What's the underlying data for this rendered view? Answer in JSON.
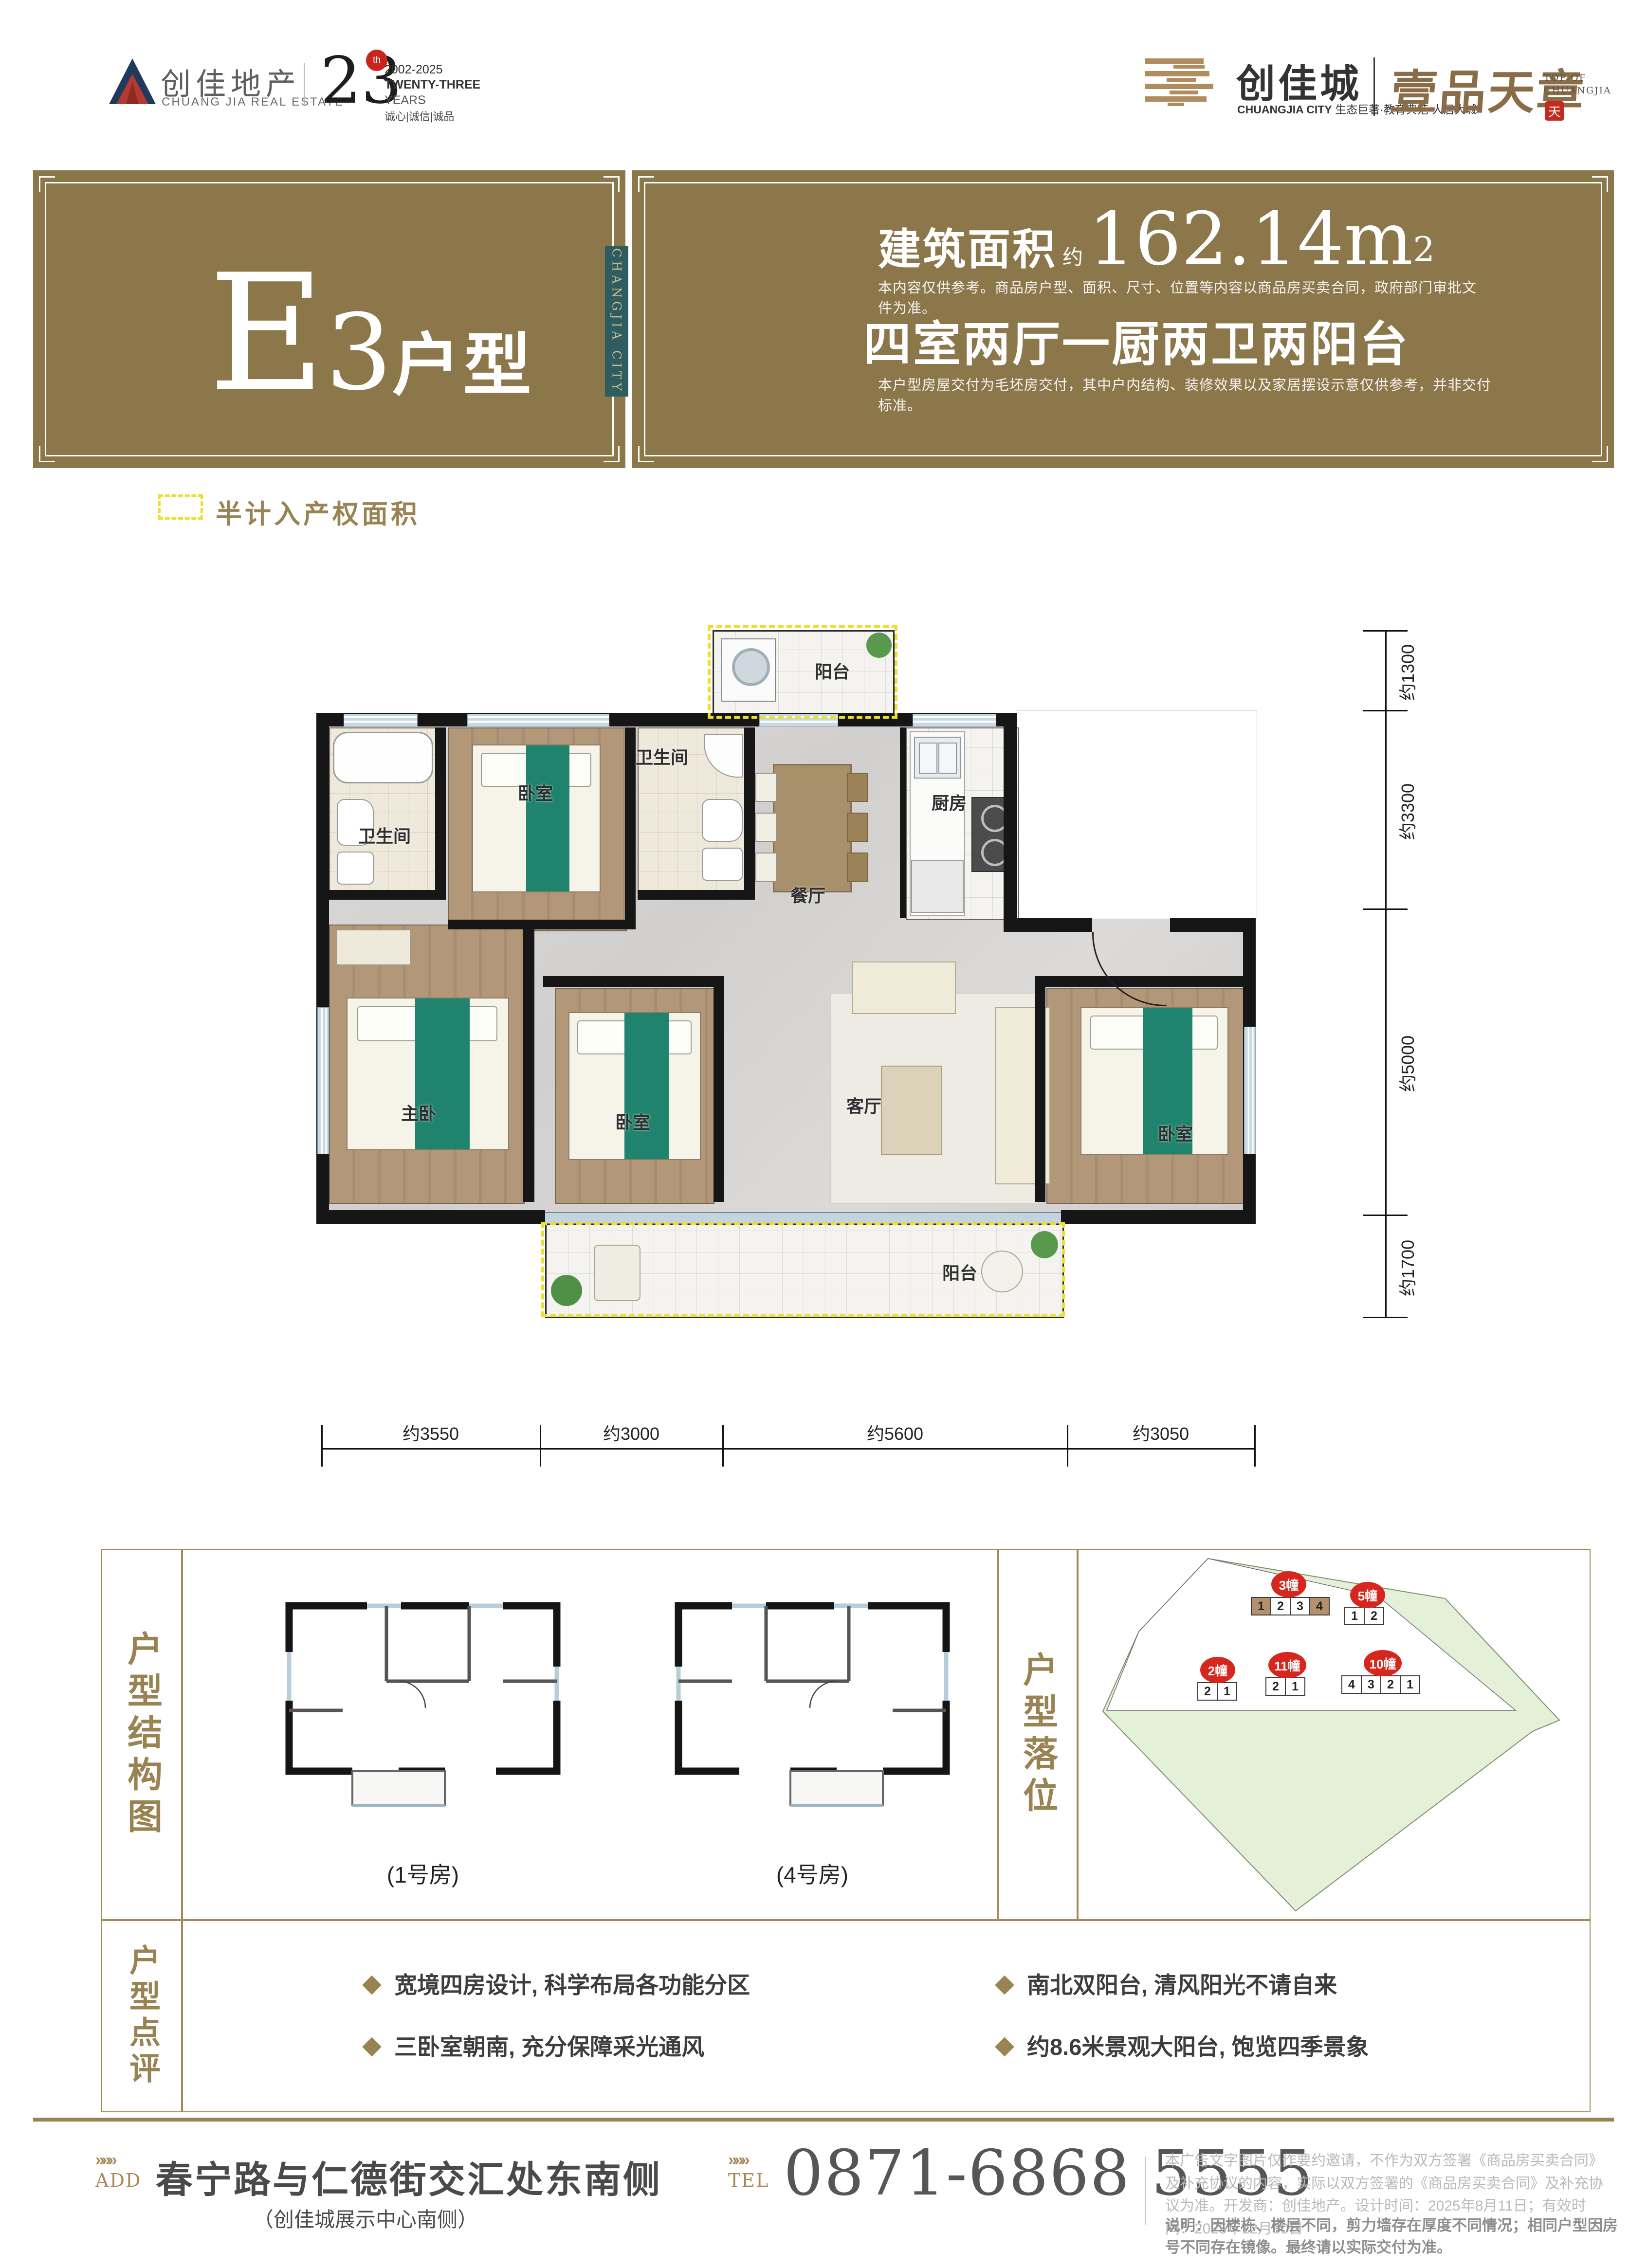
{
  "brand_left": {
    "cn": "创佳地产",
    "en": "CHUANG JIA REAL ESTATE",
    "years_num": "23",
    "years_sup": "th",
    "years_range": "2002-2025",
    "years_en": "TWENTY-THREE",
    "years_label": "YEARS",
    "slogan": "诚心|诚信|诚品"
  },
  "brand_right": {
    "cn": "创佳城",
    "en_bold": "CHUANGJIA CITY",
    "tagline": "生态巨著·教育典范·人居大城",
    "calligraphy": "壹品天章",
    "top_en_1": "TOP OF",
    "top_en_2": "CHUANGJIA",
    "seal": "天"
  },
  "header": {
    "unit_main": "E",
    "unit_num": "3",
    "unit_suffix": "户型",
    "side_tab": "CHANGJIA CITY",
    "area_label": "建筑面积",
    "area_approx": "约",
    "area_value": "162.14m",
    "area_sup": "2",
    "disclaimer1": "本内容仅供参考。商品房户型、面积、尺寸、位置等内容以商品房买卖合同，政府部门审批文件为准。",
    "layout_desc": "四室两厅一厨两卫两阳台",
    "disclaimer2": "本户型房屋交付为毛坯房交付，其中户内结构、装修效果以及家居摆设示意仅供参考，并非交付标准。"
  },
  "legend": {
    "label": "半计入产权面积"
  },
  "floorplan": {
    "rooms": [
      {
        "label": "阳台"
      },
      {
        "label": "卫生间"
      },
      {
        "label": "卧室"
      },
      {
        "label": "卫生间"
      },
      {
        "label": "厨房"
      },
      {
        "label": "餐厅"
      },
      {
        "label": "主卧"
      },
      {
        "label": "卧室"
      },
      {
        "label": "客厅"
      },
      {
        "label": "卧室"
      },
      {
        "label": "阳台"
      }
    ],
    "dims_bottom": [
      "约3550",
      "约3000",
      "约5600",
      "约3050"
    ],
    "dims_right": [
      "约1300",
      "约3300",
      "约5000",
      "约1700"
    ]
  },
  "structure": {
    "title": "户型结构图",
    "captions": [
      "(1号房)",
      "(4号房)"
    ]
  },
  "location": {
    "title": "户型落位",
    "buildings": [
      {
        "name": "3幢",
        "units": [
          "1",
          "2",
          "3",
          "4"
        ]
      },
      {
        "name": "5幢",
        "units": [
          "1",
          "2"
        ]
      },
      {
        "name": "2幢",
        "units": [
          "2",
          "1"
        ]
      },
      {
        "name": "11幢",
        "units": [
          "2",
          "1"
        ]
      },
      {
        "name": "10幢",
        "units": [
          "4",
          "3",
          "2",
          "1"
        ]
      }
    ]
  },
  "review": {
    "title": "户型点评",
    "bullets": [
      "宽境四房设计, 科学布局各功能分区",
      "三卧室朝南, 充分保障采光通风",
      "南北双阳台, 清风阳光不请自来",
      "约8.6米景观大阳台, 饱览四季景象"
    ]
  },
  "footer": {
    "chevrons": "»»»",
    "add_label": "ADD",
    "address": "春宁路与仁德街交汇处东南侧",
    "address_sub": "（创佳城展示中心南侧）",
    "tel_label": "TEL",
    "phone": "0871-6868 5555",
    "legal1": "本广告文字图片仅作要约邀请，不作为双方签署《商品房买卖合同》及补充协议的内容，实际以双方签署的《商品房买卖合同》及补充协议为准。开发商：创佳地产。设计时间：2025年8月11日；有效时间：2025年12月30日",
    "legal2": "说明：因楼栋、楼层不同，剪力墙存在厚度不同情况；相同户型因房号不同存在镜像。最终请以实际交付为准。"
  },
  "colors": {
    "gold_band": "#8b774a",
    "gold_text": "#9a8352",
    "teal_tab": "#2d5d61",
    "marker_red": "#d7261e",
    "site_green": "#e5f0d8",
    "dash_yellow": "#ecdf2e"
  }
}
